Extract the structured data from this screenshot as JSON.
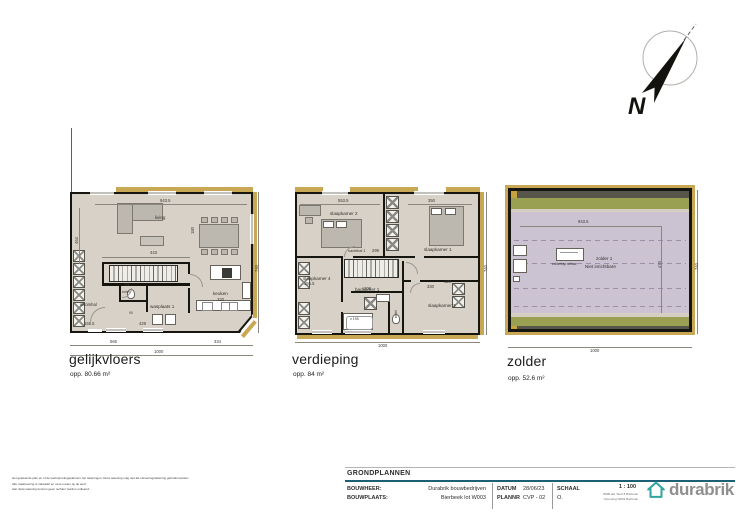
{
  "compass": {
    "label": "N"
  },
  "plans": [
    {
      "name": "gelijkvloers",
      "area": "opp. 80.66 m²",
      "rooms": [
        "living",
        "keuken",
        "320",
        "wasplaats 1",
        "inkomhal",
        "toilet"
      ],
      "dims": [
        "943.5",
        "464",
        "443",
        "155.5",
        "429",
        "151",
        "90",
        "180",
        "566",
        "334",
        "1000",
        "740"
      ]
    },
    {
      "name": "verdieping",
      "area": "opp. 84 m²",
      "rooms": [
        "slaapkamer 2",
        "slaapkamer 1",
        "nachthal 1",
        "slaapkamer 4",
        "badkamer 1",
        "toilet",
        "slaapkamer 3"
      ],
      "dims": [
        "553.5",
        "350",
        "299",
        "208",
        "155.5",
        "330",
        "120",
        "x 195",
        "1000",
        "740"
      ]
    },
    {
      "name": "zolder",
      "area": "opp. 52.6 m²",
      "rooms": [
        "zolder 1",
        "Niet inrichtbare",
        "zoldertrap schaar"
      ],
      "dims": [
        "943.5",
        "470",
        "1000",
        "740"
      ]
    }
  ],
  "titleblock": {
    "section": "GRONDPLANNEN",
    "bouwheer_label": "BOUWHEER:",
    "bouwheer_value": "Durabrik bouwbedrijven",
    "bouwplaats_label": "BOUWPLAATS:",
    "bouwplaats_value": "Bierbeek lot W003",
    "datum_label": "DATUM",
    "datum_value": "28/06/23",
    "plannr_label": "PLANNR",
    "plannr_value": "CVP - 02",
    "schaal_label": "SCHAAL",
    "schaal_sub": "O.",
    "schaal_value": "1 : 100",
    "fine_print_1": "BMB afd. Werf 8 Bierbeek",
    "fine_print_2": "Opmeting W003 Bierbeek",
    "logo_text": "durabrik"
  },
  "disclaimer": {
    "line1": "Het getekende plan en of de werfopmetingsplannen zijn tekeningen. Deze tekening mag niet als uitvoeringstekening gebruikt worden.",
    "line2": "Alle maatvoering is indicatief en na te meten op de werf.",
    "line3": "Aan deze tekening kunnen geen rechten worden ontleend."
  }
}
